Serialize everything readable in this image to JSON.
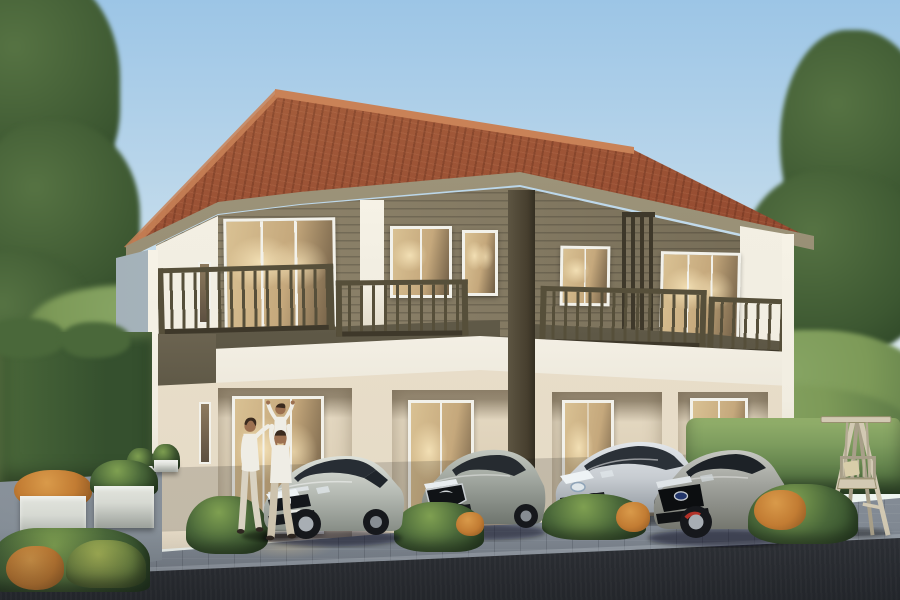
{
  "scene": {
    "label": "3D architectural rendering of a modern two-storey townhouse block at dusk",
    "environment": "residential driveway with four parked cars, a family walking to the entrance, clipped hedges, trees and a wooden swing bench"
  },
  "colors": {
    "sky_top": "#9cc5e6",
    "sky_mid": "#c6ddec",
    "sky_horizon": "#eaf3ef",
    "roof_light": "#b06a44",
    "roof_main": "#93492f",
    "roof_dark": "#6f3420",
    "roof_ridge": "#c98257",
    "fascia": "#a39a80",
    "eave_shadow": "#5f5947",
    "siding_light": "#968b71",
    "siding": "#847a63",
    "siding_shadow": "#6e6550",
    "trim_white": "#f1ede1",
    "band_white": "#f4f0e5",
    "band_shadow": "#d6cfbc",
    "railing": "#564f3a",
    "railing_dark": "#3e382a",
    "glass_frame": "#f2f1ea",
    "glass_warm": "#c5a87c",
    "glass_glow": "#f2dfb4",
    "glass_dark": "#6e5c44",
    "ground_wall": "#ede3d0",
    "porch_wall": "#e2d6bf",
    "porch_shadow": "#b6a88d",
    "side_wall": "#c2ccd2",
    "side_wall_dark": "#9fadb5",
    "hedge_dark": "#35502e",
    "hedge_mid": "#4a683a",
    "hedge_light": "#7d9c5e",
    "hedge_top": "#93b06b",
    "foliage_dark": "#3c5731",
    "foliage_mid": "#567343",
    "foliage_light": "#7d9a58",
    "orange_shrub": "#c27c33",
    "orange_bright": "#d99a4a",
    "planter_white": "#d6d9d2",
    "paver_light": "#9aa2ac",
    "paver_dark": "#7c848e",
    "asphalt": "#34373d",
    "asphalt_light": "#4a4e55",
    "swing_wood": "#d2c9b3",
    "swing_wood_dark": "#a89f89",
    "car_glass": "#2b3138",
    "car_tire": "#16181c",
    "car_rim": "#a8aeb4",
    "caliper_red": "#b23229",
    "skin": "#9c7050",
    "hair": "#3a2a1e",
    "cloth_white": "#efede5",
    "cloth_tan": "#cfc6b2",
    "civic_body": "#b5bab3",
    "mazda_body": "#989e97",
    "prius_body": "#c7ccd1",
    "ford_body": "#9b9d97"
  },
  "objects": {
    "building": {
      "label": "two-storey townhouse block: terracotta hip roof, brown horizontal-siding upper floor with balconies and dark railings, cream ground floor with four glass entrances"
    },
    "cars": [
      {
        "label": "silver Honda Civic sedan parked at the first unit"
      },
      {
        "label": "grey Mazda hatchback parked at the second unit"
      },
      {
        "label": "silver Toyota Prius parked at the third unit"
      },
      {
        "label": "grey Ford Focus hot hatch parked at the fourth unit"
      }
    ],
    "people": [
      {
        "label": "woman in white walking across the driveway"
      },
      {
        "label": "man in white carrying a child on his shoulders"
      }
    ],
    "landscape": {
      "left_hedge": {
        "label": "tall clipped hedge wall beside the left garden"
      },
      "right_hedge": {
        "label": "sunlit hedge behind the swing bench"
      },
      "planters": {
        "label": "square concrete planters with green and orange shrubs"
      },
      "low_hedges": {
        "label": "low hedges with orange accents between parking bays"
      },
      "trees": {
        "label": "large green trees flanking the house"
      }
    },
    "furniture": {
      "swing": {
        "label": "wooden A-frame swing bench with cushion"
      }
    }
  }
}
